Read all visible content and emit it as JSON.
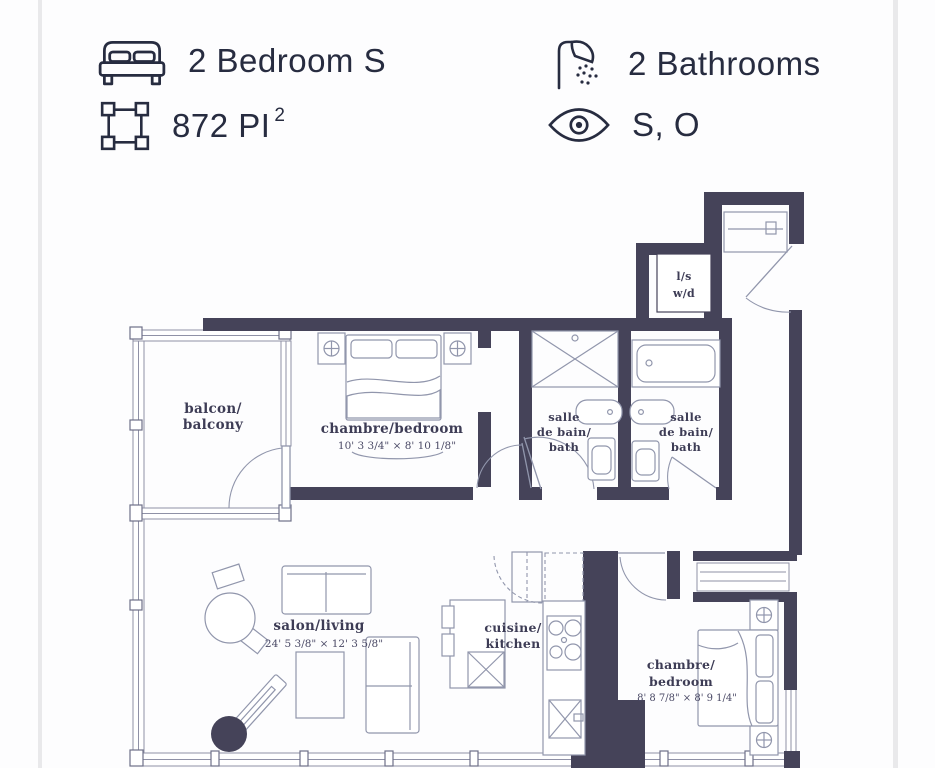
{
  "colors": {
    "wall": "#454359",
    "furniture": "#9196ac",
    "label": "#3d3c55",
    "header_text": "#272c40"
  },
  "header": {
    "bedrooms": {
      "label": "2 Bedroom S"
    },
    "area": {
      "value": "872 PI",
      "superscript": "2"
    },
    "bathrooms": {
      "label": "2 Bathrooms"
    },
    "orientation": {
      "label": "S, O"
    }
  },
  "floorplan": {
    "rooms": {
      "balcony": {
        "lines": [
          "balcon/",
          "balcony"
        ]
      },
      "bedroom1": {
        "label": "chambre/bedroom",
        "dims": "10' 3 3/4\" × 8' 10 1/8\""
      },
      "bath1": {
        "lines": [
          "salle",
          "de bain/",
          "bath"
        ]
      },
      "bath2": {
        "lines": [
          "salle",
          "de bain/",
          "bath"
        ]
      },
      "laundry": {
        "lines": [
          "l/s",
          "w/d"
        ]
      },
      "living": {
        "label": "salon/living",
        "dims": "24' 5 3/8\" × 12' 3 5/8\""
      },
      "kitchen": {
        "lines": [
          "cuisine/",
          "kitchen"
        ]
      },
      "bedroom2": {
        "lines": [
          "chambre/",
          "bedroom"
        ],
        "dims": "8' 8 7/8\" × 8' 9 1/4\""
      }
    }
  }
}
